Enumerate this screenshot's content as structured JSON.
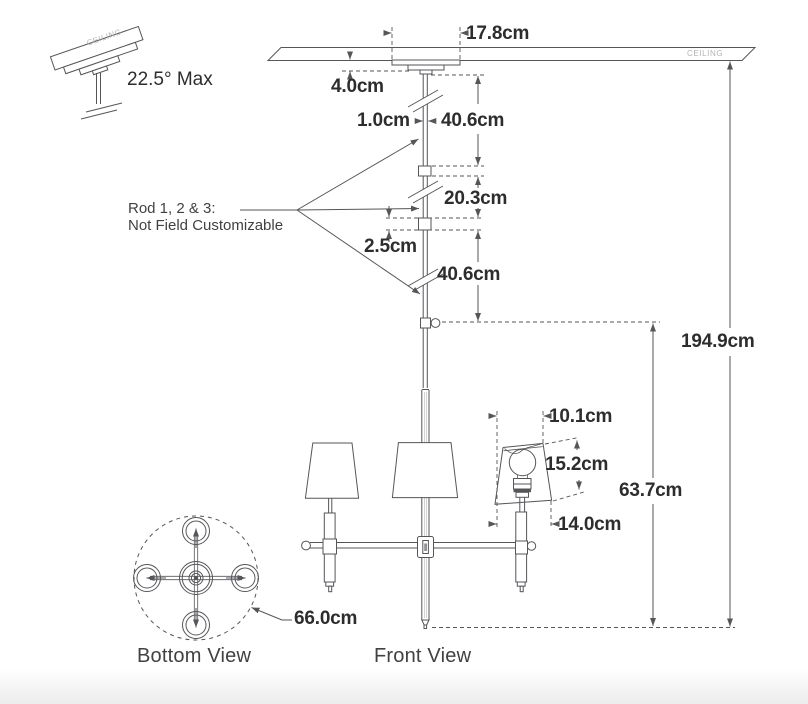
{
  "labels": {
    "tilt_max": "22.5° Max",
    "rod_note_line1": "Rod 1, 2 & 3:",
    "rod_note_line2": "Not Field Customizable",
    "bottom_view": "Bottom View",
    "front_view": "Front View",
    "ceiling": "CEILING",
    "ceiling_tilted": "CEILING"
  },
  "dimensions": {
    "canopy_width": "17.8cm",
    "canopy_height": "4.0cm",
    "rod_diameter": "1.0cm",
    "rod_segment_1": "40.6cm",
    "rod_segment_2": "20.3cm",
    "coupler_length": "2.5cm",
    "rod_segment_3": "40.6cm",
    "overall_height": "194.9cm",
    "fixture_height": "63.7cm",
    "shade_top_diameter": "10.1cm",
    "shade_height": "15.2cm",
    "shade_bottom_diameter": "14.0cm",
    "fixture_diameter": "66.0cm"
  },
  "colors": {
    "line": "#55565a",
    "dim_text": "#2d2d2d",
    "label_text": "#414141",
    "ceiling_text": "#b4b4b4",
    "background": "#ffffff"
  }
}
